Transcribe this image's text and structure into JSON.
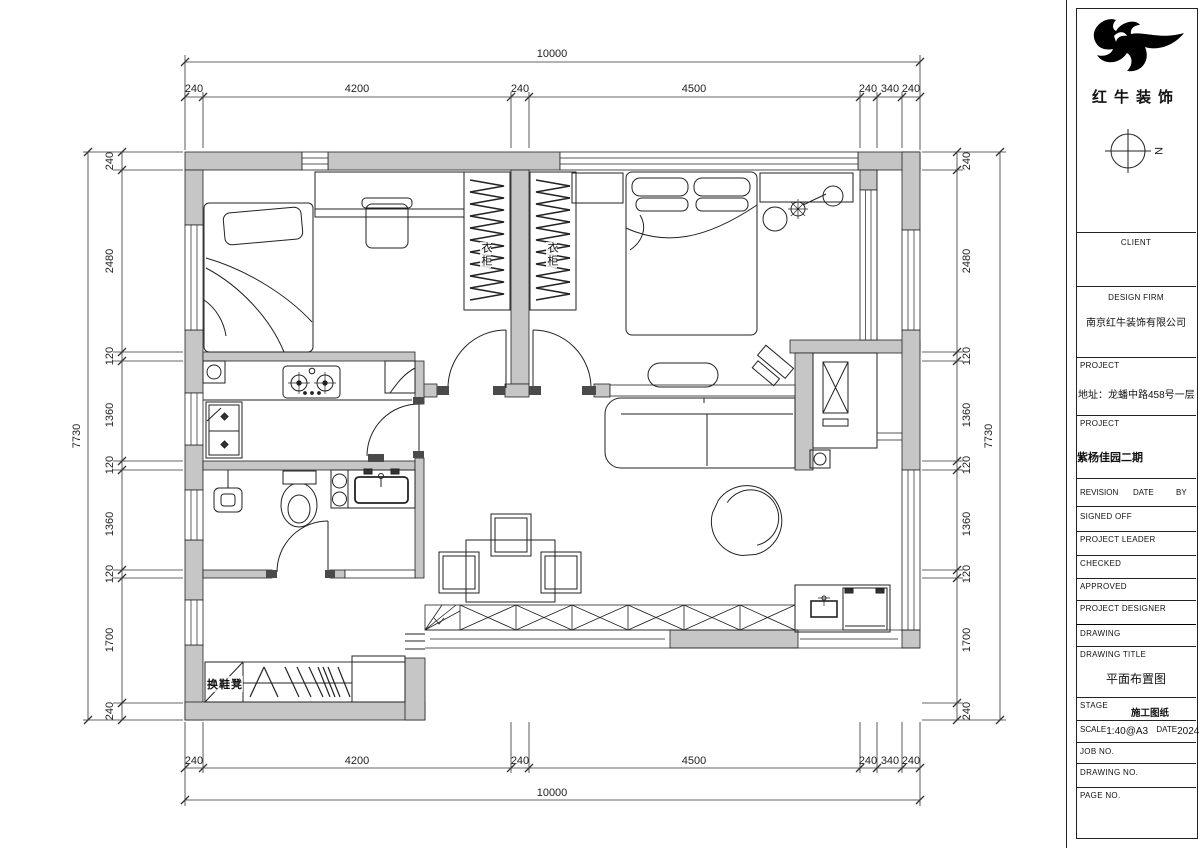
{
  "title_block": {
    "logo_text": "红牛装饰",
    "north_label": "N",
    "client_label": "CLIENT",
    "design_firm_label": "DESIGN FIRM",
    "design_firm_name": "南京红牛装饰有限公司",
    "project_label": "PROJECT",
    "project_address": "地址：龙蟠中路458号一层",
    "project_label_2": "PROJECT",
    "project_name": "紫杨佳园二期",
    "revision_label": "REVISION",
    "revision_date_label": "DATE",
    "revision_by_label": "BY",
    "signed_off_label": "SIGNED OFF",
    "project_leader_label": "PROJECT LEADER",
    "checked_label": "CHECKED",
    "approved_label": "APPROVED",
    "project_designer_label": "PROJECT DESIGNER",
    "drawing_label": "DRAWING",
    "drawing_title_label": "DRAWING TITLE",
    "drawing_title": "平面布置图",
    "stage_label": "STAGE",
    "stage_value": "施工图纸",
    "scale_label": "SCALE",
    "scale_value": "1:40@A3",
    "date_label": "DATE",
    "date_value": "2024",
    "job_no_label": "JOB NO.",
    "drawing_no_label": "DRAWING NO.",
    "page_no_label": "PAGE NO."
  },
  "plan_labels": {
    "wardrobe_1": "衣柜",
    "wardrobe_2": "衣柜",
    "shoe_bench": "换鞋凳"
  },
  "dimensions": {
    "top": {
      "overall": "10000",
      "segments": [
        "240",
        "4200",
        "240",
        "4500",
        "240",
        "340",
        "240"
      ]
    },
    "bottom": {
      "overall": "10000",
      "segments": [
        "240",
        "4200",
        "240",
        "4500",
        "240",
        "340",
        "240"
      ]
    },
    "left": {
      "overall": "7730",
      "segments": [
        "240",
        "2480",
        "120",
        "1360",
        "120",
        "1360",
        "120",
        "1700",
        "240"
      ]
    },
    "right": {
      "overall": "7730",
      "segments": [
        "240",
        "2480",
        "120",
        "1360",
        "120",
        "1360",
        "120",
        "1700",
        "240"
      ]
    }
  },
  "colors": {
    "wall_fill": "#c6c6c6",
    "line": "#1a1a1a",
    "background": "#ffffff"
  }
}
